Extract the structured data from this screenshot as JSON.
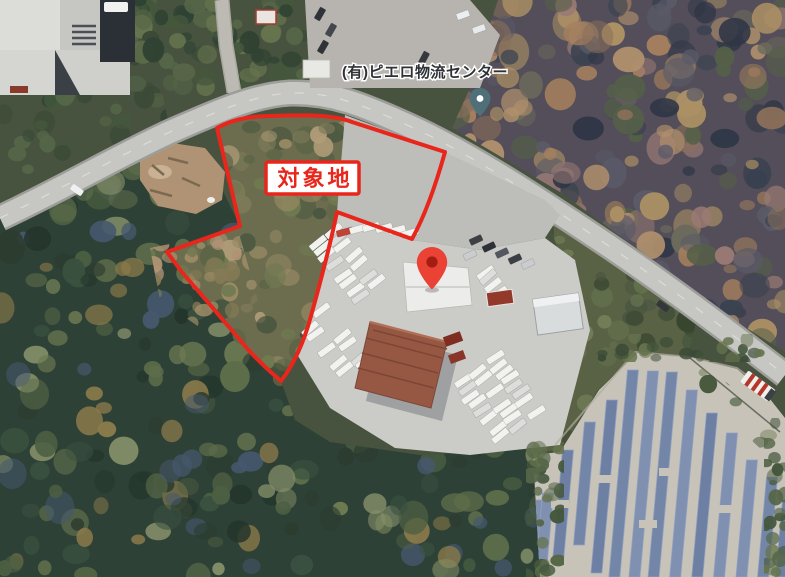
{
  "map": {
    "annotation": {
      "site_label": "対象地"
    },
    "poi": {
      "label": "(有)ピエロ物流センター",
      "pin_icon": "place-pin",
      "marker_icon": "red-map-pin"
    }
  },
  "colors": {
    "boundary_red": "#e8261c",
    "site_label_text": "#e8261c",
    "site_label_bg": "#ffffff",
    "marker_red": "#ea4335",
    "marker_inner_red": "#a31d12",
    "place_pin_teal": "#4f7078",
    "place_pin_dot": "#ffffff",
    "poi_label_text": "#2e3236",
    "road_gray": "#c6c6c3",
    "forest_dark_green": "#2e4136",
    "autumn_brown": "#a5805e",
    "solar_panel_blue": "#6d7fa3",
    "solar_ground_tan": "#c7c3b9",
    "yard_gray": "#cbcbc8",
    "truck_white": "#f2f2ef",
    "warehouse_roof_redbrown": "#975843"
  }
}
